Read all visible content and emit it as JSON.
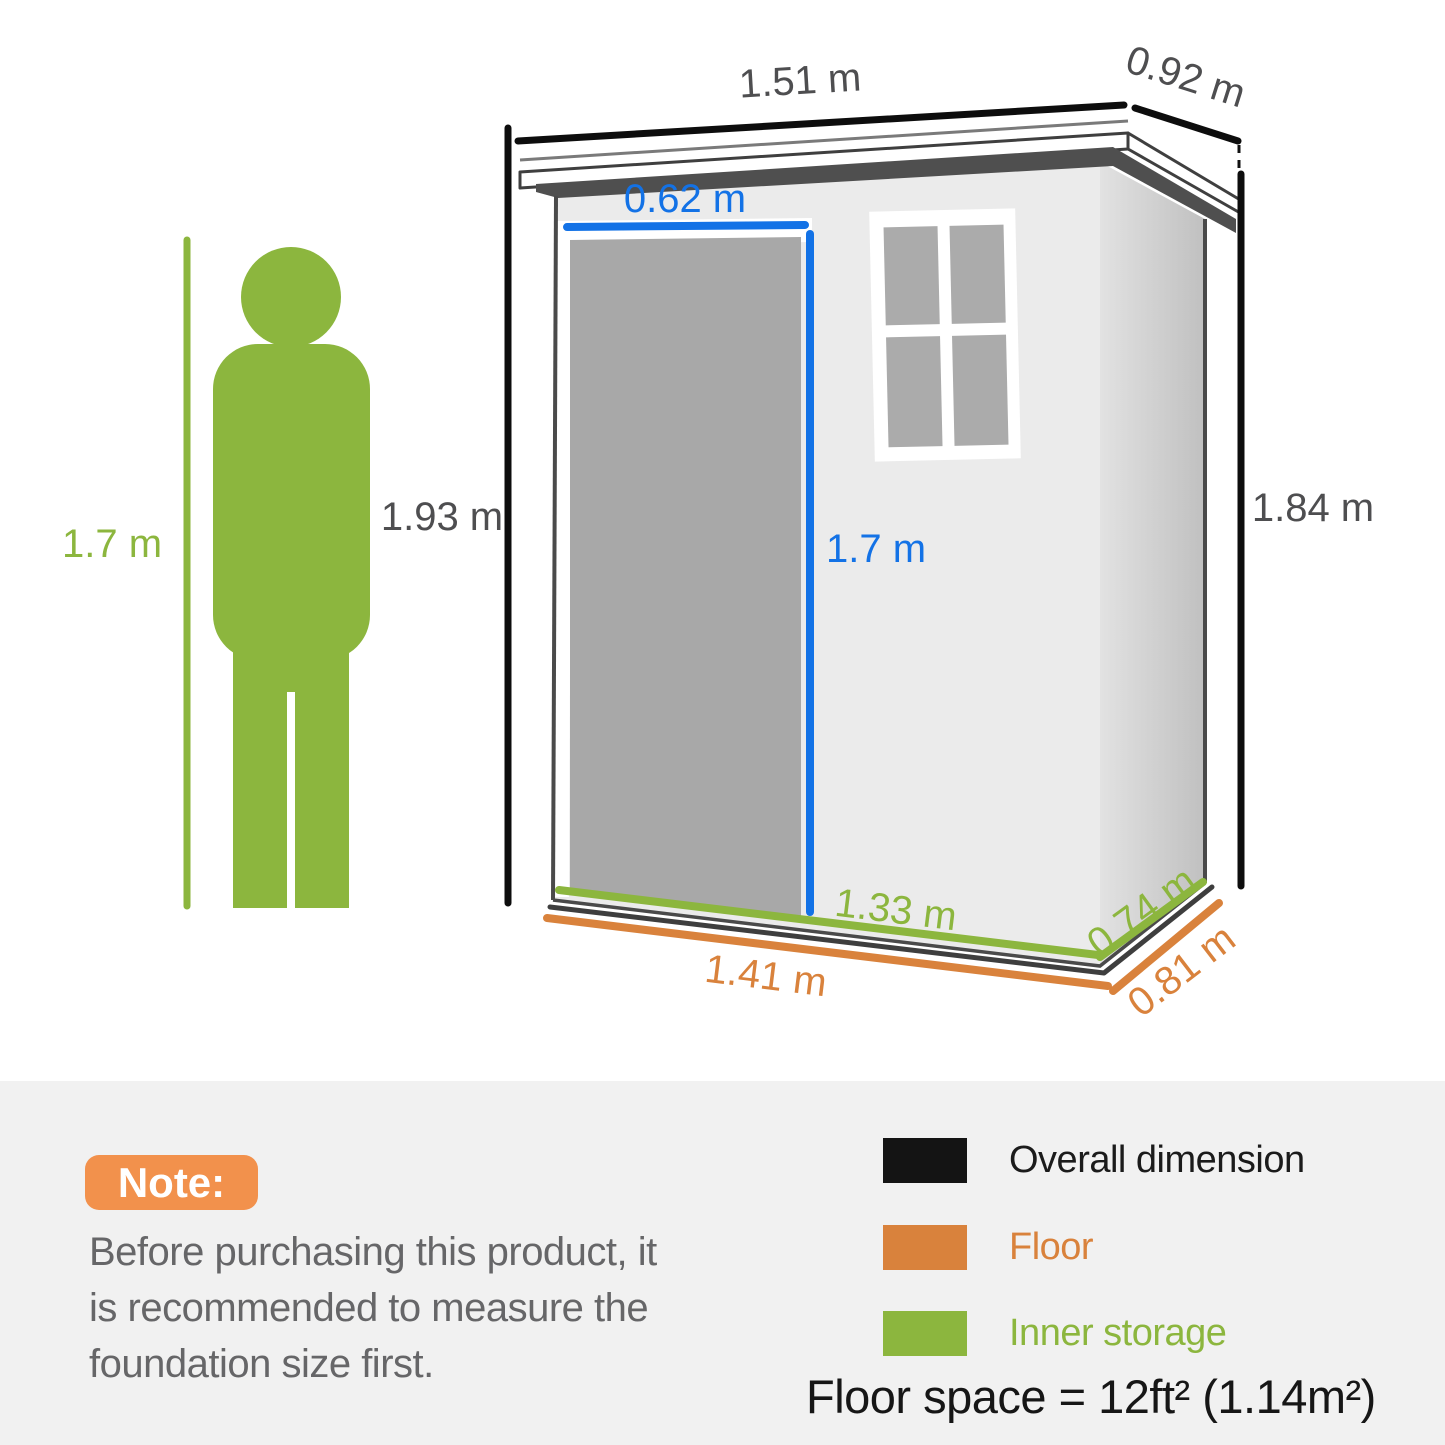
{
  "diagram": {
    "person": {
      "height_label": "1.7 m"
    },
    "shed": {
      "overall_width": "1.51 m",
      "overall_depth": "0.92 m",
      "height_front": "1.93 m",
      "height_back": "1.84 m",
      "door_width": "0.62 m",
      "door_height": "1.7 m",
      "inner_width": "1.33 m",
      "inner_depth": "0.74 m",
      "floor_width": "1.41 m",
      "floor_depth": "0.81 m"
    }
  },
  "note": {
    "badge": "Note:",
    "lines": [
      "Before purchasing this product, it",
      "is recommended to measure the",
      "foundation size first."
    ]
  },
  "legend": {
    "items": [
      {
        "label": "Overall dimension",
        "color": "#1b1b1b"
      },
      {
        "label": "Floor",
        "color": "#d9823c"
      },
      {
        "label": "Inner storage",
        "color": "#8cb63e"
      }
    ],
    "floor_space": "Floor space = 12ft² (1.14m²)"
  },
  "colors": {
    "dimension_black": "#0d0d0d",
    "accent_blue": "#1372e6",
    "accent_green": "#8cb63e",
    "accent_orange": "#d9823c",
    "note_badge_orange": "#f2914c",
    "section_background": "#f1f1f1",
    "shed_front_wall": "#ebebeb",
    "shed_side_wall": "#c9c9c9",
    "shed_door": "#a8a8a8",
    "roof_shadow": "#4f4f4f"
  }
}
